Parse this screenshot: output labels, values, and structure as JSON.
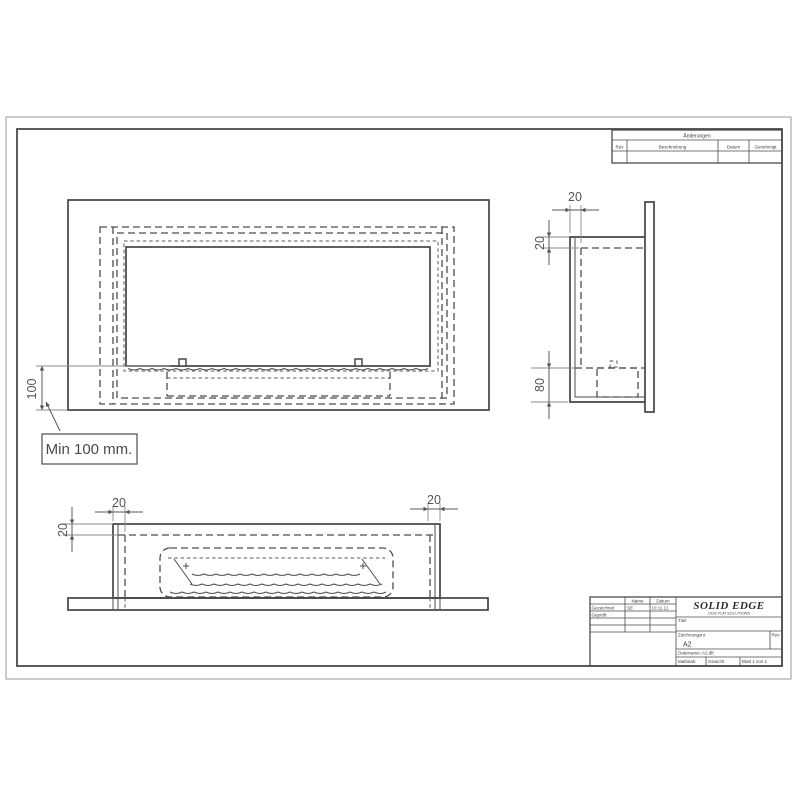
{
  "page": {
    "type": "CAD engineering drawing sheet",
    "colors": {
      "background": "#ffffff",
      "object_line": "#454545",
      "dimension": "#5a5a5a",
      "border": "#4a4a4a"
    }
  },
  "callout": {
    "text": "Min 100 mm."
  },
  "dimensions": {
    "front_offset": "100",
    "side_depth": "20",
    "side_top_inset": "20",
    "side_burner": "80",
    "bottom_left_wall": "20",
    "bottom_right_wall": "20",
    "bottom_top_inset": "20"
  },
  "revision_table": {
    "title": "Änderungen",
    "col_rev": "Rev",
    "col_description": "Beschreibung",
    "col_date": "Datum",
    "col_approved": "Genehmigt"
  },
  "title_block": {
    "logo_title": "SOLID EDGE",
    "logo_subtitle": "UGS PLM SOLUTIONS",
    "header_name": "Name",
    "header_date": "Datum",
    "row1_label": "Gezeichnet",
    "row1_name": "SE",
    "row1_date": "10.11.11",
    "row2_label": "Geprüft",
    "field_title_label": "Titel",
    "field_drawing_no_label": "Zeichnungsnr.",
    "field_drawing_no_value": "A2",
    "field_rev_label": "Rev",
    "field_filename": "Dateiname: A2.dft",
    "field_scale_label": "Maßstab",
    "field_weight_label": "Gewicht",
    "field_sheet_label": "Blatt 1 von 1"
  }
}
